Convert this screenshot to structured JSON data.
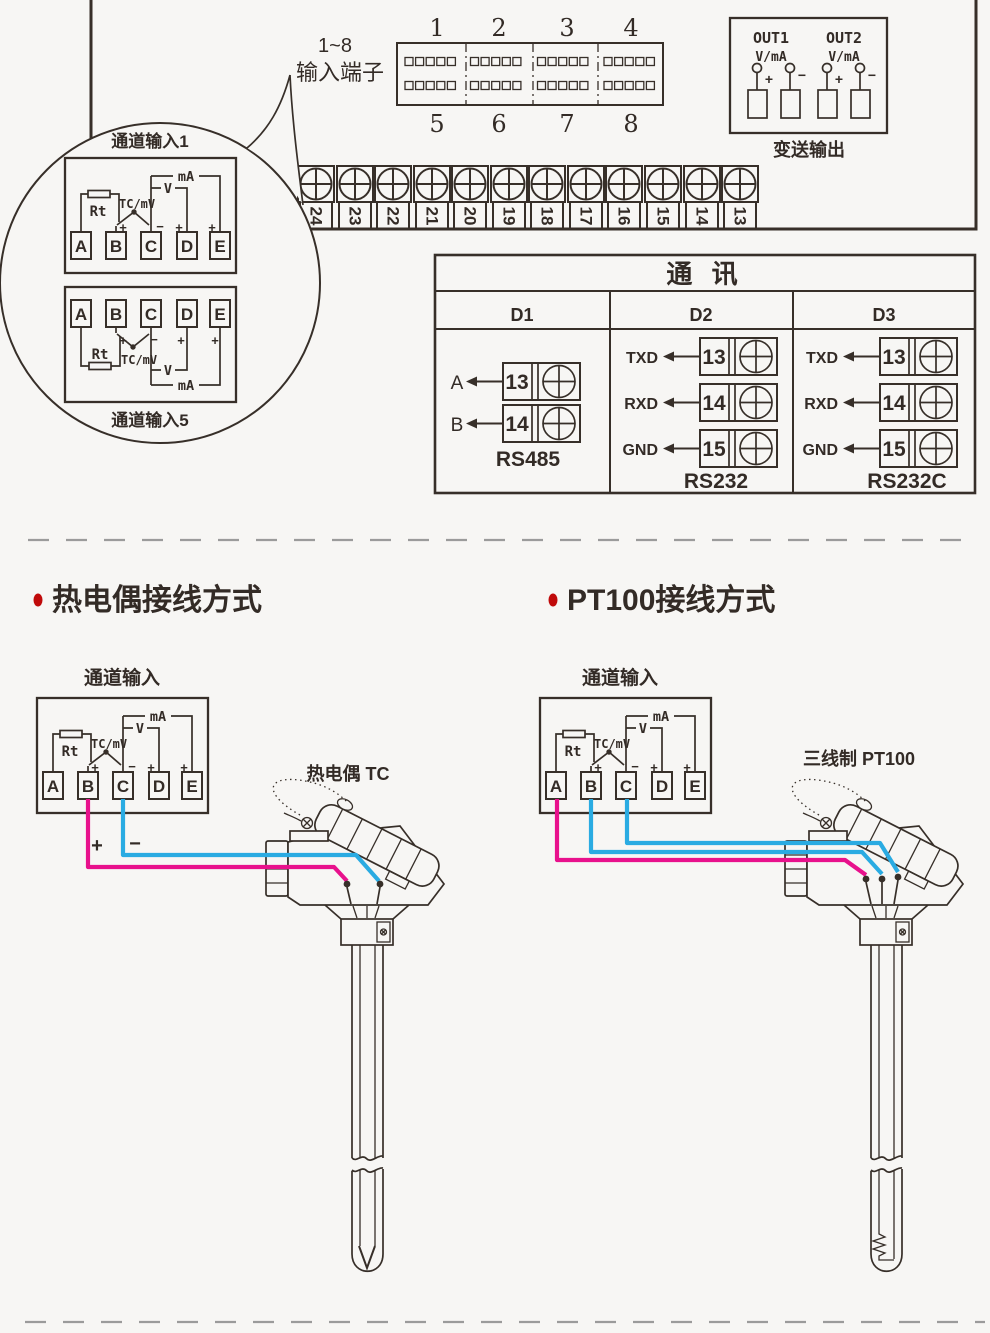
{
  "colors": {
    "line": "#372f29",
    "wire_pink": "#e8118c",
    "wire_blue": "#2aabe2",
    "bullet_red": "#c00a0a",
    "background": "#f7f6f4"
  },
  "top_section": {
    "connector_label_line1": "1~8",
    "connector_label_line2": "输入端子",
    "connector_top_numbers": [
      "1",
      "2",
      "3",
      "4"
    ],
    "connector_bottom_numbers": [
      "5",
      "6",
      "7",
      "8"
    ],
    "output_box": {
      "out1_label": "OUT1",
      "out2_label": "OUT2",
      "signal_type": "V/mA",
      "plus": "+",
      "minus": "−",
      "caption": "变送输出"
    },
    "terminal_strip_numbers": [
      "24",
      "23",
      "22",
      "21",
      "20",
      "19",
      "18",
      "17",
      "16",
      "15",
      "14",
      "13"
    ]
  },
  "channel_box": {
    "ma_label": "mA",
    "v_label": "V",
    "rt_label": "Rt",
    "tc_mv_label": "TC/mV",
    "plus": "+",
    "minus": "−",
    "terminals": [
      "A",
      "B",
      "C",
      "D",
      "E"
    ]
  },
  "balloon": {
    "channel1_label": "通道输入1",
    "channel5_label": "通道输入5"
  },
  "comm_table": {
    "title": "通 讯",
    "columns": [
      {
        "header": "D1",
        "caption": "RS485",
        "rows": [
          {
            "signal": "A",
            "terminal": "13"
          },
          {
            "signal": "B",
            "terminal": "14"
          }
        ]
      },
      {
        "header": "D2",
        "caption": "RS232",
        "rows": [
          {
            "signal": "TXD",
            "terminal": "13"
          },
          {
            "signal": "RXD",
            "terminal": "14"
          },
          {
            "signal": "GND",
            "terminal": "15"
          }
        ]
      },
      {
        "header": "D3",
        "caption": "RS232C",
        "rows": [
          {
            "signal": "TXD",
            "terminal": "13"
          },
          {
            "signal": "RXD",
            "terminal": "14"
          },
          {
            "signal": "GND",
            "terminal": "15"
          }
        ]
      }
    ]
  },
  "thermocouple_section": {
    "heading": "热电偶接线方式",
    "channel_label": "通道输入",
    "plus": "+",
    "minus": "−",
    "sensor_label": "热电偶 TC"
  },
  "pt100_section": {
    "heading": "PT100接线方式",
    "channel_label": "通道输入",
    "sensor_label": "三线制 PT100"
  }
}
